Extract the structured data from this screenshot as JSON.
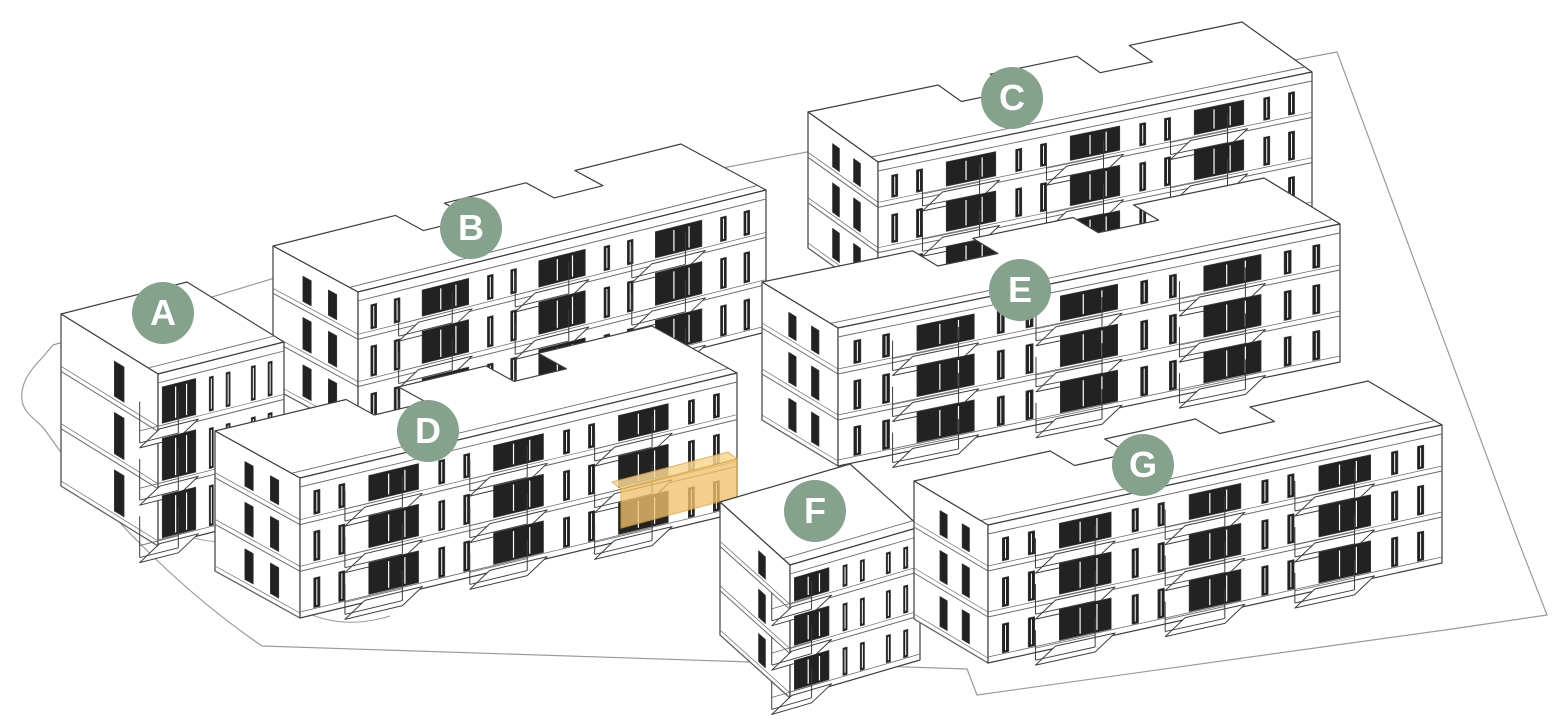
{
  "canvas": {
    "width": 1562,
    "height": 720,
    "background": "#ffffff"
  },
  "colors": {
    "badge": "#85A28C",
    "badge_text": "#FFFFFF",
    "outline": "#3E3E3E",
    "detail_line": "#6A6A6A",
    "light_line": "#9A9A9A",
    "window_dark": "#222222",
    "wall": "#FFFFFF",
    "highlight_fill": "#F2C26B",
    "highlight_top_fill": "#F6D694",
    "highlight_stroke": "#DFA940"
  },
  "badge_style": {
    "diameter": 62,
    "font_size": 36
  },
  "buildings": [
    {
      "id": "A",
      "label": "A",
      "type": "small",
      "z": 4,
      "badge": {
        "x": 163,
        "y": 313
      },
      "ftl": [
        158,
        374
      ],
      "ftr": [
        284,
        342
      ],
      "height": 172,
      "back": [
        -97,
        -60
      ],
      "bays": 3,
      "balcony_bays": [
        0
      ],
      "floors": 3
    },
    {
      "id": "B",
      "label": "B",
      "type": "long",
      "z": 2,
      "badge": {
        "x": 471,
        "y": 228
      },
      "ftl": [
        358,
        292
      ],
      "ftr": [
        766,
        190
      ],
      "height": 142,
      "back": [
        -85,
        -46
      ],
      "bays": 7,
      "balcony_bays": [
        1,
        3,
        5
      ],
      "floors": 3
    },
    {
      "id": "C",
      "label": "C",
      "type": "long",
      "z": 1,
      "badge": {
        "x": 1012,
        "y": 98
      },
      "ftl": [
        878,
        162
      ],
      "ftr": [
        1312,
        72
      ],
      "height": 136,
      "back": [
        -70,
        -50
      ],
      "bays": 7,
      "balcony_bays": [
        1,
        3,
        5
      ],
      "floors": 3
    },
    {
      "id": "D",
      "label": "D",
      "type": "long",
      "z": 5,
      "badge": {
        "x": 428,
        "y": 431
      },
      "ftl": [
        300,
        478
      ],
      "ftr": [
        737,
        373
      ],
      "height": 140,
      "back": [
        -85,
        -47
      ],
      "bays": 7,
      "balcony_bays": [
        1,
        3,
        5
      ],
      "floors": 3
    },
    {
      "id": "E",
      "label": "E",
      "type": "long",
      "z": 3,
      "badge": {
        "x": 1020,
        "y": 290
      },
      "ftl": [
        838,
        328
      ],
      "ftr": [
        1340,
        224
      ],
      "height": 138,
      "back": [
        -76,
        -46
      ],
      "bays": 7,
      "balcony_bays": [
        1,
        3,
        5
      ],
      "floors": 3
    },
    {
      "id": "F",
      "label": "F",
      "type": "small",
      "z": 6,
      "badge": {
        "x": 815,
        "y": 511
      },
      "ftl": [
        790,
        565
      ],
      "ftr": [
        920,
        527
      ],
      "height": 133,
      "back": [
        -70,
        -63
      ],
      "bays": 3,
      "balcony_bays": [
        0
      ],
      "floors": 3
    },
    {
      "id": "G",
      "label": "G",
      "type": "long",
      "z": 7,
      "badge": {
        "x": 1143,
        "y": 465
      },
      "ftl": [
        988,
        525
      ],
      "ftr": [
        1442,
        425
      ],
      "height": 138,
      "back": [
        -74,
        -44
      ],
      "bays": 7,
      "balcony_bays": [
        1,
        3,
        5
      ],
      "floors": 3
    }
  ],
  "highlight": {
    "building": "D",
    "front_polygon": [
      [
        621,
        489
      ],
      [
        737,
        459
      ],
      [
        737,
        497
      ],
      [
        621,
        528
      ]
    ],
    "top_polygon": [
      [
        621,
        489
      ],
      [
        737,
        459
      ],
      [
        728,
        452
      ],
      [
        612,
        482
      ]
    ]
  },
  "site": {
    "boundary_path": "M53,345 L500,210 L1337,52 L1516,535 L1547,615 L1452,629 L977,695 L967,669 L262,646 C180,590 100,510 45,430 C38,420 24,415 22,400 C20,384 30,370 42,358 L53,345",
    "paths": [
      "M168,527 Q205,548 243,539",
      "M248,560 Q305,642 390,616",
      "M735,600 Q788,662 866,644"
    ]
  },
  "balcony_offset": [
    -20,
    14
  ]
}
